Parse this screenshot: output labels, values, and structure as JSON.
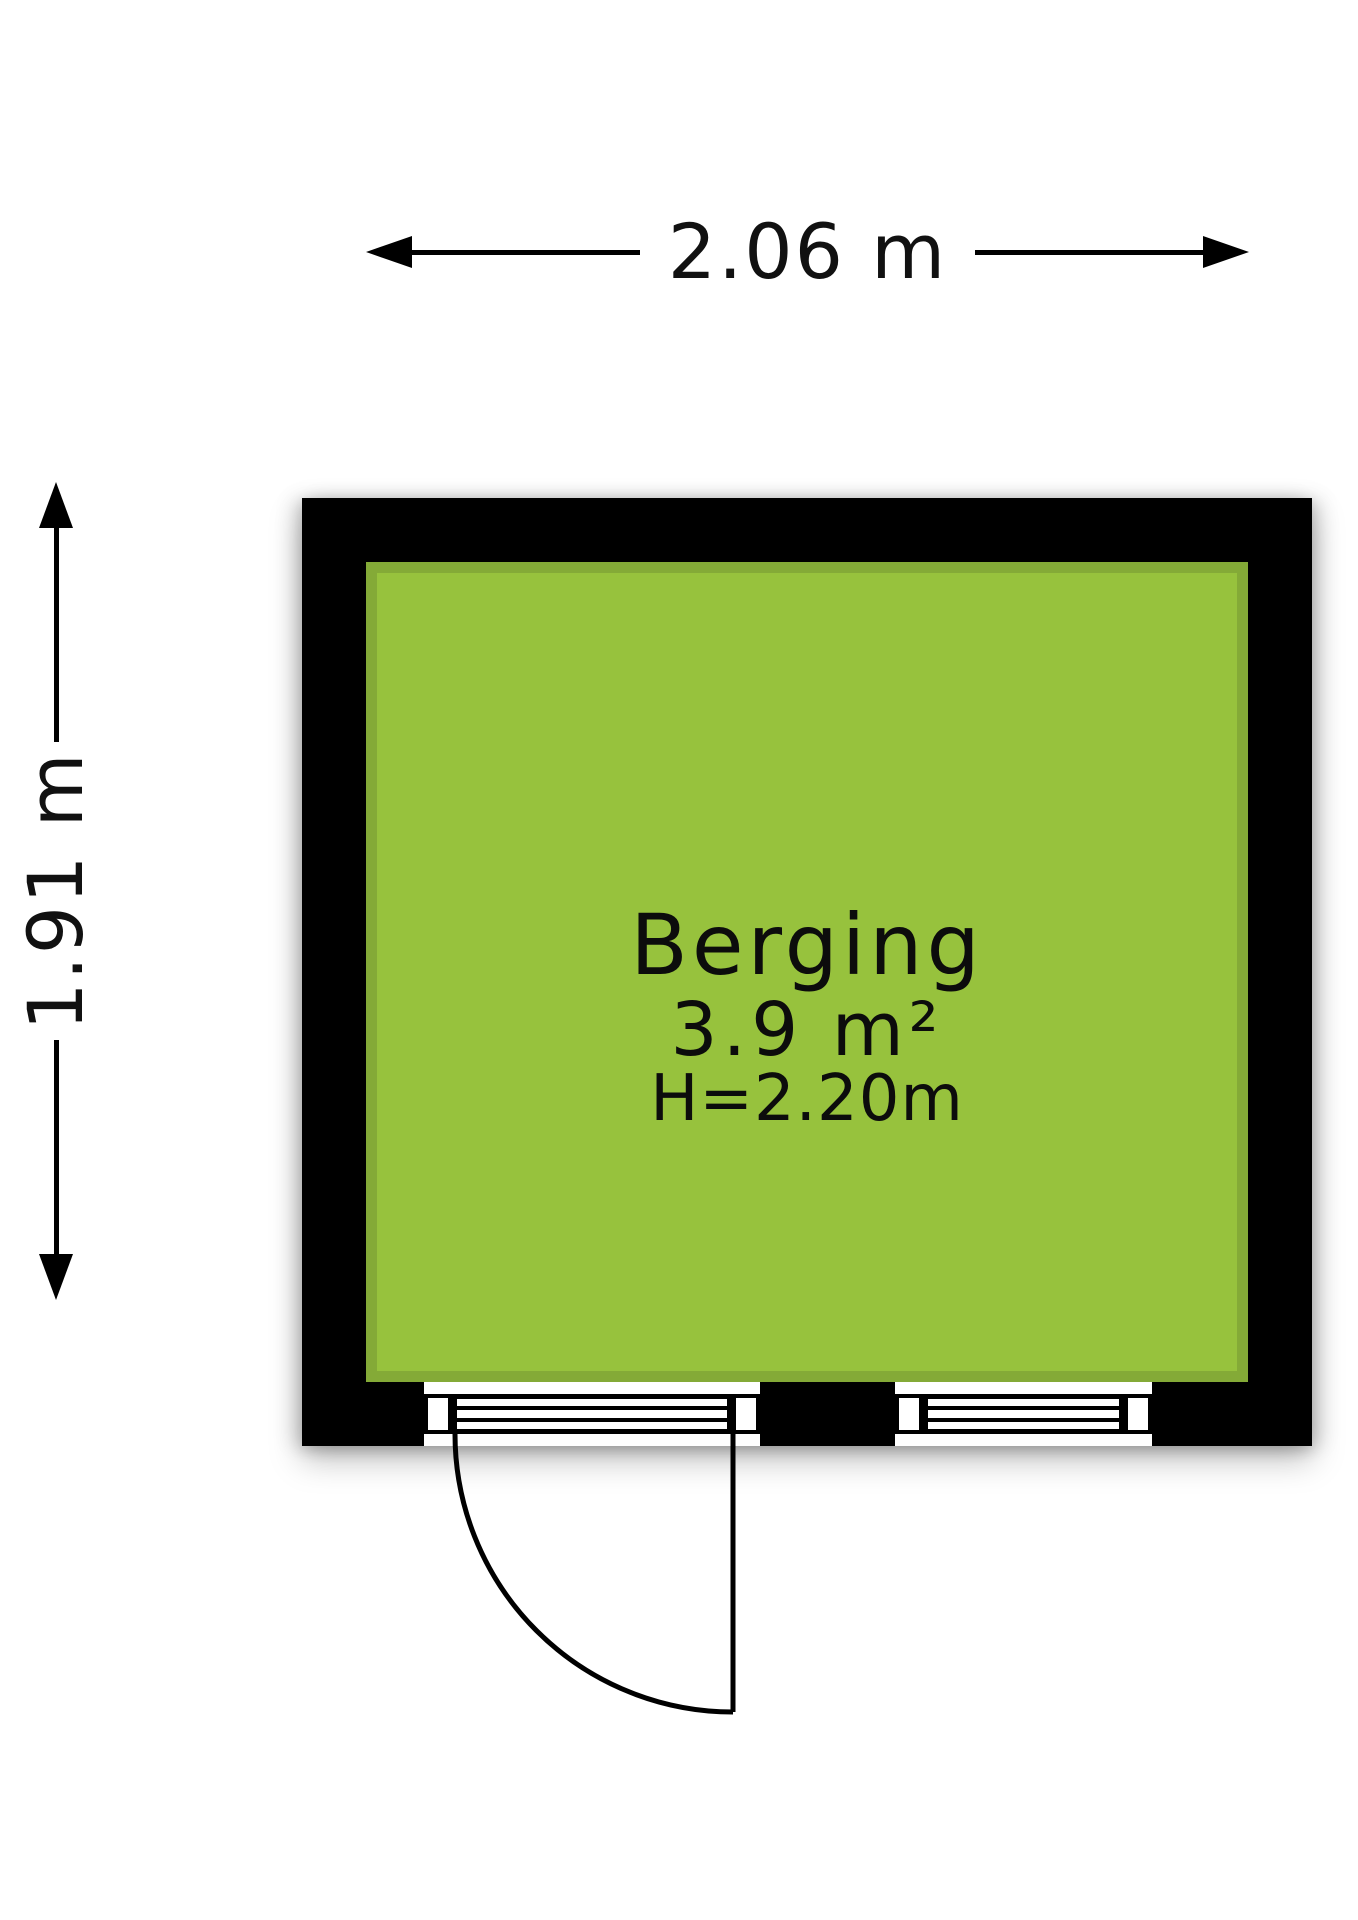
{
  "floorplan": {
    "room": {
      "name": "Berging",
      "area": "3.9 m²",
      "ceiling_height": "H=2.20m"
    },
    "dimensions": {
      "width_label": "2.06 m",
      "height_label": "1.91 m"
    },
    "colors": {
      "floor": "#97c23d",
      "floor_edge": "#84aa37",
      "wall": "#000000",
      "line": "#111111"
    }
  }
}
